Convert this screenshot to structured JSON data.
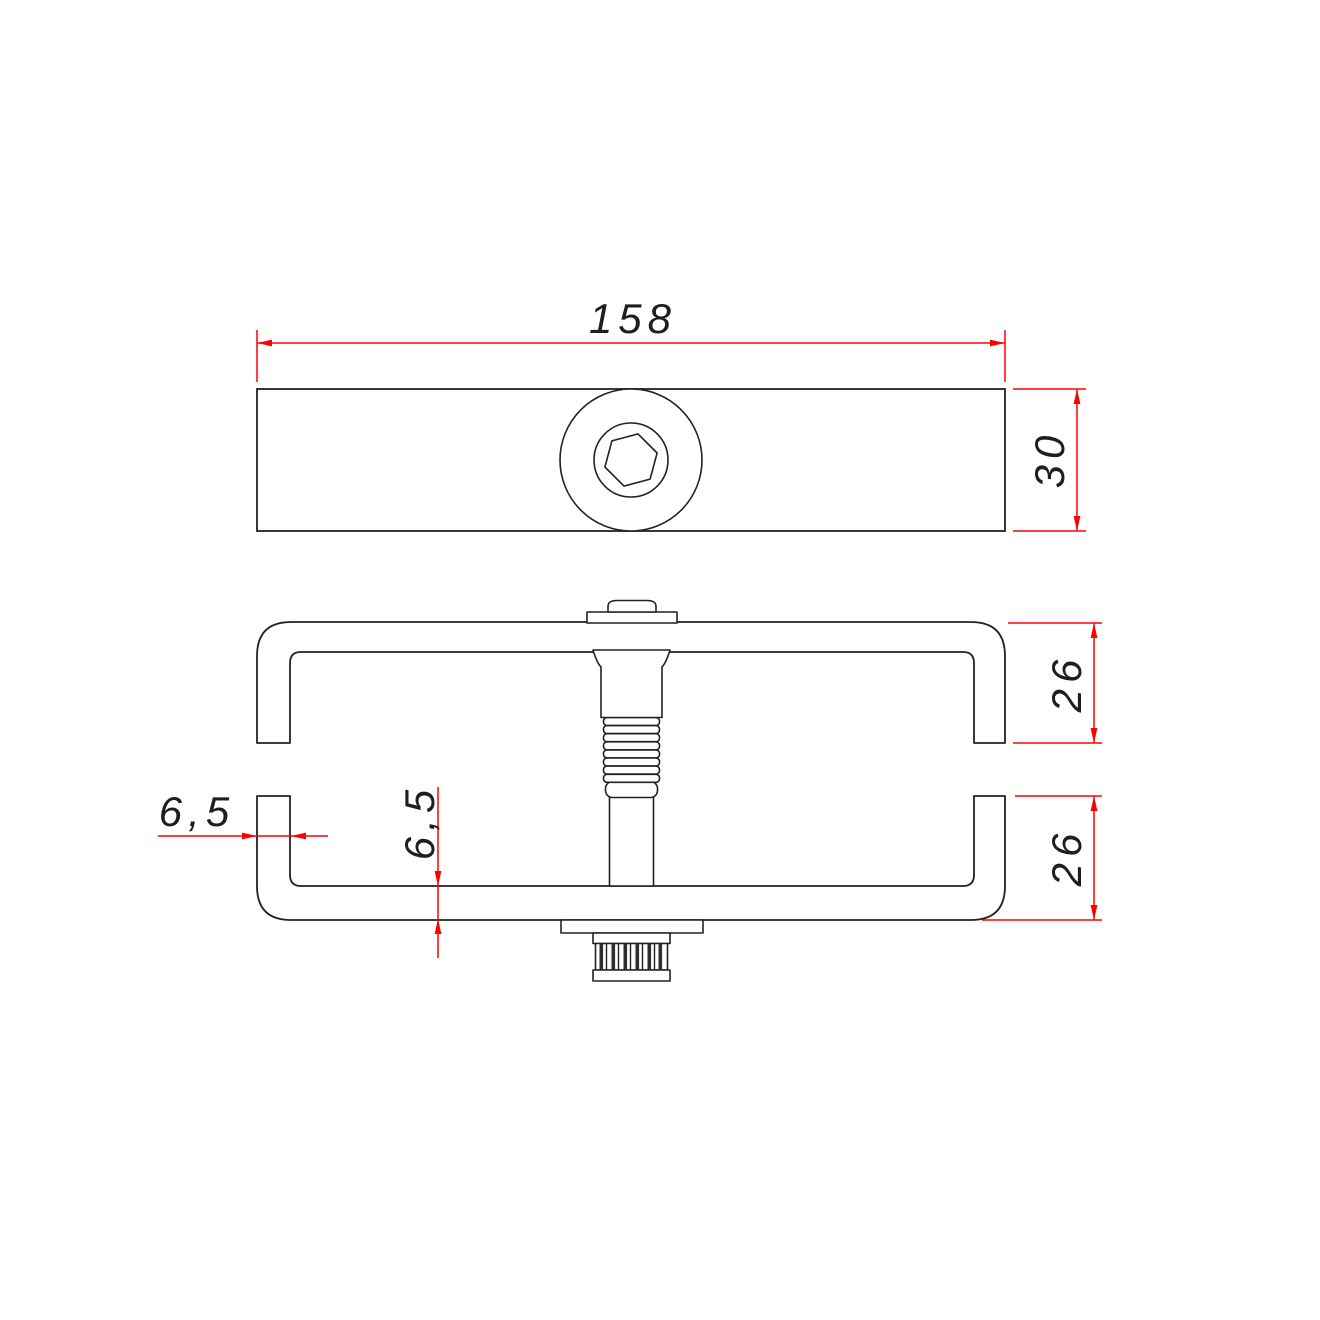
{
  "drawing": {
    "background": "#ffffff",
    "line_color": "#222222",
    "dimension_color": "#ff0000",
    "text_color": "#1f1d1e",
    "knurl_color": "#2e2e2e",
    "dimensions": {
      "total_width": "158",
      "bar_height": "30",
      "upper_channel_depth": "26",
      "lower_channel_depth": "26",
      "side_wall_thickness": "6,5",
      "bottom_wall_thickness": "6,5"
    }
  }
}
